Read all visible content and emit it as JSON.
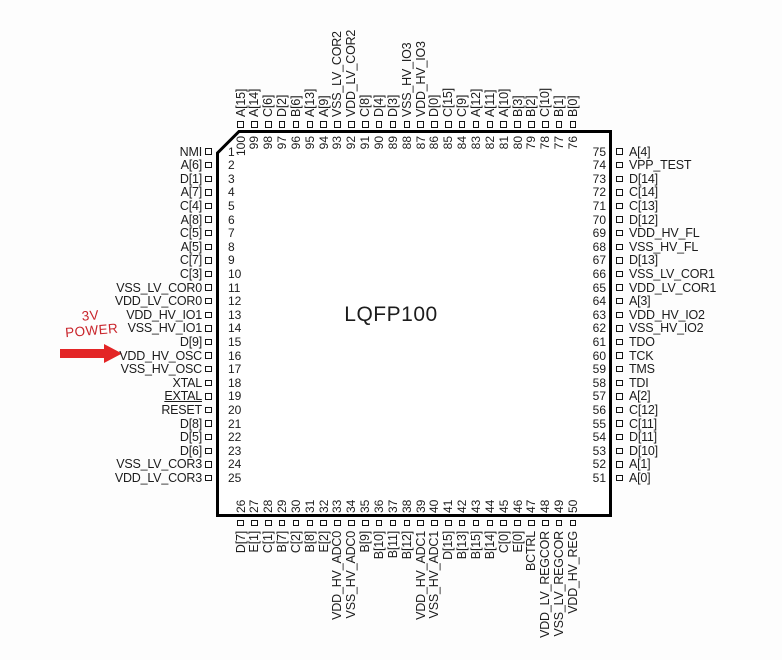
{
  "chip": {
    "package_label": "LQFP100"
  },
  "annotation": {
    "line1": "3V",
    "line2": "POWER"
  },
  "colors": {
    "accent_red": "#c9252c",
    "arrow_red": "#e32526",
    "ink": "#1c1c1c"
  },
  "pins": {
    "left": [
      {
        "num": 1,
        "label": "NMI"
      },
      {
        "num": 2,
        "label": "A[6]"
      },
      {
        "num": 3,
        "label": "D[1]"
      },
      {
        "num": 4,
        "label": "A[7]"
      },
      {
        "num": 5,
        "label": "C[4]"
      },
      {
        "num": 6,
        "label": "A[8]"
      },
      {
        "num": 7,
        "label": "C[5]"
      },
      {
        "num": 8,
        "label": "A[5]"
      },
      {
        "num": 9,
        "label": "C[7]"
      },
      {
        "num": 10,
        "label": "C[3]"
      },
      {
        "num": 11,
        "label": "VSS_LV_COR0"
      },
      {
        "num": 12,
        "label": "VDD_LV_COR0"
      },
      {
        "num": 13,
        "label": "VDD_HV_IO1"
      },
      {
        "num": 14,
        "label": "VSS_HV_IO1"
      },
      {
        "num": 15,
        "label": "D[9]"
      },
      {
        "num": 16,
        "label": "VDD_HV_OSC"
      },
      {
        "num": 17,
        "label": "VSS_HV_OSC"
      },
      {
        "num": 18,
        "label": "XTAL"
      },
      {
        "num": 19,
        "label": "EXTAL",
        "underline": true
      },
      {
        "num": 20,
        "label": "RESET"
      },
      {
        "num": 21,
        "label": "D[8]"
      },
      {
        "num": 22,
        "label": "D[5]"
      },
      {
        "num": 23,
        "label": "D[6]"
      },
      {
        "num": 24,
        "label": "VSS_LV_COR3"
      },
      {
        "num": 25,
        "label": "VDD_LV_COR3"
      }
    ],
    "top": [
      {
        "num": 100,
        "label": "A[15]"
      },
      {
        "num": 99,
        "label": "A[14]"
      },
      {
        "num": 98,
        "label": "C[6]"
      },
      {
        "num": 97,
        "label": "D[2]"
      },
      {
        "num": 96,
        "label": "B[6]"
      },
      {
        "num": 95,
        "label": "A[13]"
      },
      {
        "num": 94,
        "label": "A[9]"
      },
      {
        "num": 93,
        "label": "VSS_LV_COR2"
      },
      {
        "num": 92,
        "label": "VDD_LV_COR2"
      },
      {
        "num": 91,
        "label": "C[8]"
      },
      {
        "num": 90,
        "label": "D[4]"
      },
      {
        "num": 89,
        "label": "D[3]"
      },
      {
        "num": 88,
        "label": "VSS_HV_IO3"
      },
      {
        "num": 87,
        "label": "VDD_HV_IO3"
      },
      {
        "num": 86,
        "label": "D[0]"
      },
      {
        "num": 85,
        "label": "C[15]"
      },
      {
        "num": 84,
        "label": "C[9]"
      },
      {
        "num": 83,
        "label": "A[12]"
      },
      {
        "num": 82,
        "label": "A[11]"
      },
      {
        "num": 81,
        "label": "A[10]"
      },
      {
        "num": 80,
        "label": "B[3]"
      },
      {
        "num": 79,
        "label": "B[2]"
      },
      {
        "num": 78,
        "label": "C[10]"
      },
      {
        "num": 77,
        "label": "B[1]"
      },
      {
        "num": 76,
        "label": "B[0]"
      }
    ],
    "right": [
      {
        "num": 75,
        "label": "A[4]"
      },
      {
        "num": 74,
        "label": "VPP_TEST"
      },
      {
        "num": 73,
        "label": "D[14]"
      },
      {
        "num": 72,
        "label": "C[14]"
      },
      {
        "num": 71,
        "label": "C[13]"
      },
      {
        "num": 70,
        "label": "D[12]"
      },
      {
        "num": 69,
        "label": "VDD_HV_FL"
      },
      {
        "num": 68,
        "label": "VSS_HV_FL"
      },
      {
        "num": 67,
        "label": "D[13]"
      },
      {
        "num": 66,
        "label": "VSS_LV_COR1"
      },
      {
        "num": 65,
        "label": "VDD_LV_COR1"
      },
      {
        "num": 64,
        "label": "A[3]"
      },
      {
        "num": 63,
        "label": "VDD_HV_IO2"
      },
      {
        "num": 62,
        "label": "VSS_HV_IO2"
      },
      {
        "num": 61,
        "label": "TDO"
      },
      {
        "num": 60,
        "label": "TCK"
      },
      {
        "num": 59,
        "label": "TMS"
      },
      {
        "num": 58,
        "label": "TDI"
      },
      {
        "num": 57,
        "label": "A[2]"
      },
      {
        "num": 56,
        "label": "C[12]"
      },
      {
        "num": 55,
        "label": "C[11]"
      },
      {
        "num": 54,
        "label": "D[11]"
      },
      {
        "num": 53,
        "label": "D[10]"
      },
      {
        "num": 52,
        "label": "A[1]"
      },
      {
        "num": 51,
        "label": "A[0]"
      }
    ],
    "bottom": [
      {
        "num": 26,
        "label": "D[7]"
      },
      {
        "num": 27,
        "label": "E[1]"
      },
      {
        "num": 28,
        "label": "C[1]"
      },
      {
        "num": 29,
        "label": "B[7]"
      },
      {
        "num": 30,
        "label": "C[2]"
      },
      {
        "num": 31,
        "label": "B[8]"
      },
      {
        "num": 32,
        "label": "E[2]"
      },
      {
        "num": 33,
        "label": "VDD_HV_ADC0"
      },
      {
        "num": 34,
        "label": "VSS_HV_ADC0"
      },
      {
        "num": 35,
        "label": "B[9]"
      },
      {
        "num": 36,
        "label": "B[10]"
      },
      {
        "num": 37,
        "label": "B[11]"
      },
      {
        "num": 38,
        "label": "B[12]"
      },
      {
        "num": 39,
        "label": "VDD_HV_ADC1"
      },
      {
        "num": 40,
        "label": "VSS_HV_ADC1"
      },
      {
        "num": 41,
        "label": "D[15]"
      },
      {
        "num": 42,
        "label": "B[13]"
      },
      {
        "num": 43,
        "label": "B[15]"
      },
      {
        "num": 44,
        "label": "B[14]"
      },
      {
        "num": 45,
        "label": "C[0]"
      },
      {
        "num": 46,
        "label": "E[0]"
      },
      {
        "num": 47,
        "label": "BCTRL"
      },
      {
        "num": 48,
        "label": "VDD_LV_REGCOR"
      },
      {
        "num": 49,
        "label": "VSS_LV_REGCOR"
      },
      {
        "num": 50,
        "label": "VDD_HV_REG"
      }
    ]
  }
}
